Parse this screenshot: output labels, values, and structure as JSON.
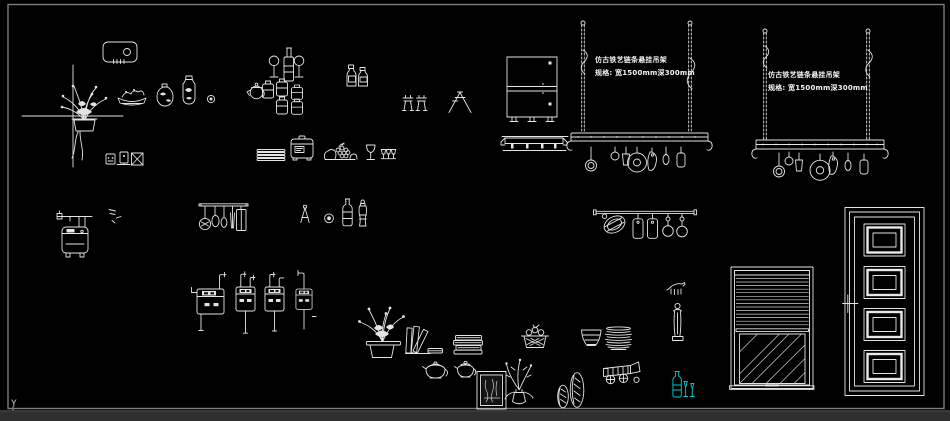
{
  "canvas": {
    "background": "#000000",
    "border_color": "#7c7c7c",
    "line_color": "#e6e6e6",
    "cyan_accent": "#00cdcd",
    "status_strip_color": "#2f2f2f",
    "ucs_y_label": "Y"
  },
  "annotations": {
    "rack_left": {
      "line1": "仿古铁艺链条悬挂吊架",
      "line2": "规格: 宽1500mm深300mm"
    },
    "rack_right": {
      "line1": "仿古铁艺链条悬挂吊架",
      "line2": "规格: 宽1500mm深300mm"
    }
  },
  "blocks": [
    "range-hood",
    "crosshair-cursor",
    "flower-arrangement",
    "food-plate",
    "gourd-vase",
    "tall-vase",
    "small-plate",
    "switch-socket-icons",
    "wine-set",
    "teapot",
    "jar-set",
    "sauce-bottles",
    "faucet-symbols",
    "funnel",
    "plate-stack",
    "rice-cooker",
    "fruit-pile",
    "goblet",
    "mini-goblets",
    "base-cabinet",
    "towel-rail",
    "pot-rack-left",
    "pot-rack-right",
    "water-heater",
    "utensil-rail",
    "trivet",
    "ring",
    "oil-bottle",
    "pepper-grinder",
    "hook-rail",
    "gas-meters",
    "flower-pot",
    "bookends",
    "book-stack",
    "fruit-basket",
    "bowl",
    "plate-stack-2",
    "teapots",
    "picture-frame",
    "plant-vase",
    "oval-vases",
    "toy-cart",
    "animal-figurine",
    "statue",
    "cyan-bottle-set",
    "window-blinds",
    "panel-door"
  ]
}
